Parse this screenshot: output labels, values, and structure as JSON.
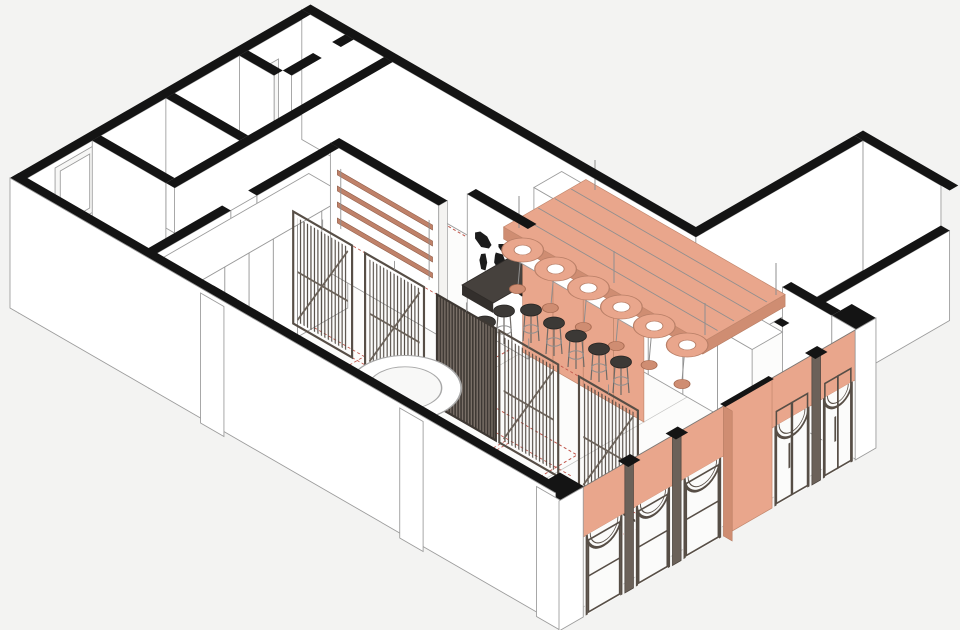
{
  "scene": {
    "type": "axonometric-interior-cutaway",
    "subject": "cafe-bar interior axonometric cutaway drawing",
    "orientation": "isometric 30-degree",
    "background": "#f3f3f2"
  },
  "colors": {
    "background": "#f3f3f2",
    "wall_cut": "#141414",
    "wall_face": "#ffffff",
    "line": "#9b9b9b",
    "coral": "#e9a68c",
    "coral_dark": "#cf8d72",
    "coral_rail": "#bf8169",
    "frame_dark": "#574e46",
    "frame_mid": "#6b6159",
    "slat": "#4d453e",
    "string_red": "#b2594e",
    "dashed_red": "#c0554a",
    "stool_seat": "#3c3936",
    "glass": "#fbfbfa",
    "floor": "#fcfcfb"
  },
  "elements": [
    {
      "name": "back-of-house-rooms",
      "count": 5,
      "style": "black cut walls"
    },
    {
      "name": "wardrobe-cabinet-row",
      "count": 1,
      "doors": 6
    },
    {
      "name": "slatted-screen-panels",
      "count": 5,
      "style": "dark frame, vertical slats, diagonal brace"
    },
    {
      "name": "string-curtain-floor-zones",
      "count": 2,
      "color_key": "string_red"
    },
    {
      "name": "projection-dashed-boxes",
      "count": 5,
      "color_key": "dashed_red"
    },
    {
      "name": "floor-ring",
      "count": 1,
      "shape": "donut"
    },
    {
      "name": "world-map-mural",
      "count": 1,
      "color": "black silhouette"
    },
    {
      "name": "coral-wall-rails",
      "count": 4
    },
    {
      "name": "bar-counter",
      "count": 1,
      "front": "coral panels, white top"
    },
    {
      "name": "bar-stools",
      "count": 7,
      "seat": "dark round"
    },
    {
      "name": "back-counter",
      "count": 1
    },
    {
      "name": "tall-cabinet",
      "count": 1
    },
    {
      "name": "suspended-ceiling-canopy",
      "count": 1,
      "beams": 4
    },
    {
      "name": "pendant-light-discs",
      "count": 6,
      "shades": 6
    },
    {
      "name": "arched-facade-bays",
      "count": 5,
      "spandrel": "coral"
    },
    {
      "name": "wide-coral-pier",
      "count": 1
    },
    {
      "name": "corner-piers",
      "count": 2,
      "cap": "black"
    },
    {
      "name": "facade-mullions",
      "count": 3
    },
    {
      "name": "side-wing-corridor",
      "count": 1
    },
    {
      "name": "wall-pilasters",
      "count": 2
    },
    {
      "name": "interior-door-frames",
      "count": 3
    },
    {
      "name": "dark-side-table",
      "count": 1
    }
  ]
}
